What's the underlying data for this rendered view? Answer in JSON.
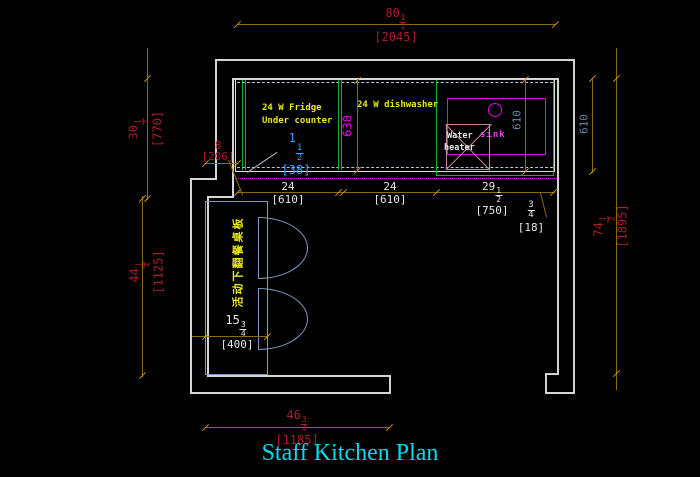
{
  "title": "Staff  Kitchen Plan",
  "labels": {
    "fridge_line1": "24 W Fridge",
    "fridge_line2": "Under counter",
    "dishwasher": "24 W dishwasher",
    "water_heater_line1": "Water",
    "water_heater_line2": "heater",
    "sink": "sink",
    "folding_table_note": "活动下翻餐桌板"
  },
  "dims": {
    "top_width": {
      "whole": "80",
      "num": "1",
      "den": "2",
      "metric": "[2045]"
    },
    "left_upper_height": {
      "whole": "30",
      "num": "1",
      "den": "4",
      "metric": "[770]"
    },
    "left_lower_height": {
      "whole": "44",
      "num": "1",
      "den": "4",
      "metric": "[1125]"
    },
    "right_height": {
      "whole": "74",
      "num": "1",
      "den": "2",
      "metric": "[1895]"
    },
    "counter_depth_outer": {
      "value": "610"
    },
    "counter_depth_inner": {
      "value": "610"
    },
    "counter_depth_mid": {
      "value": "630"
    },
    "fridge_width": {
      "whole": "24",
      "metric": "[610]"
    },
    "dishwasher_width": {
      "whole": "24",
      "metric": "[610]"
    },
    "sink_cabinet_width": {
      "whole": "29",
      "num": "1",
      "den": "2",
      "metric": "[750]"
    },
    "end_gap": {
      "num": "3",
      "den": "4",
      "metric": "[18]"
    },
    "wall_offset": {
      "whole": "8",
      "metric": "[206]"
    },
    "counter_clearance": {
      "whole": "1",
      "num": "1",
      "den": "2",
      "metric": "[38]"
    },
    "table_width": {
      "whole": "15",
      "num": "3",
      "den": "4",
      "metric": "[400]"
    },
    "bottom_width": {
      "whole": "46",
      "num": "3",
      "den": "4",
      "metric": "[1185]"
    }
  },
  "colors": {
    "background": "#000000",
    "wall": "#d4d4d4",
    "dimension_line": "#8a6a14",
    "dimension_tick": "#d89a1a",
    "dim_text_red": "#ad1b2e",
    "dim_text_white": "#e6e6e6",
    "dim_text_blue": "#6e88ac",
    "magenta": "#e800e8",
    "green": "#00b43c",
    "label_yellow": "#e8e81a",
    "leader_cyan": "#36a0ff",
    "table_blue": "#8098c0",
    "water_heater_rose": "#c58a9a",
    "title_cyan": "#00dcec"
  }
}
